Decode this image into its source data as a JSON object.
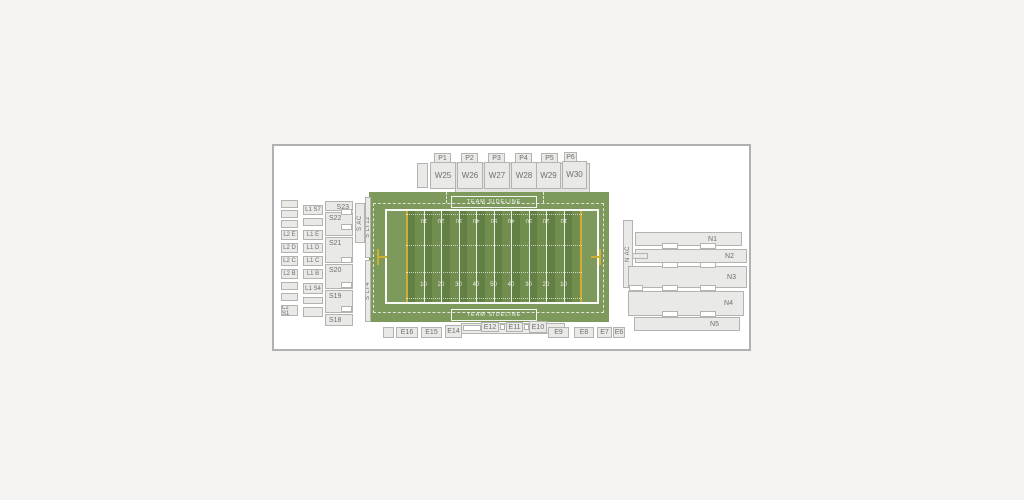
{
  "colors": {
    "page_bg": "#f5f4f2",
    "panel_bg": "#ffffff",
    "panel_border": "#b1b1b4",
    "section_fill": "#e9e9e7",
    "section_border": "#b3b3b0",
    "section_text": "#6f6f6f",
    "field_green": "#7d9a5c",
    "band_dark": "#627f44",
    "band_light": "#718e4f",
    "goal_yellow": "#cfae35"
  },
  "field": {
    "sideline_label": "TEAM SIDELINE",
    "yard_numbers": [
      "10",
      "20",
      "30",
      "40",
      "50",
      "40",
      "30",
      "20",
      "10"
    ]
  },
  "west": {
    "pods": [
      {
        "tab": "P1",
        "label": "W25"
      },
      {
        "tab": "P2",
        "label": "W26"
      },
      {
        "tab": "P3",
        "label": "W27"
      },
      {
        "tab": "P4",
        "label": "W28"
      },
      {
        "tab": "P5",
        "label": "W29"
      },
      {
        "tab": "P6",
        "label": "W30"
      }
    ]
  },
  "east": {
    "sections": [
      "E16",
      "E15",
      "E14",
      "E12",
      "E11",
      "E10",
      "E9",
      "E8",
      "E7",
      "E6"
    ]
  },
  "south": {
    "l2": [
      "L2 E",
      "L2 D",
      "L2 C",
      "L2 B",
      "L2 S1"
    ],
    "l1": [
      "L1 S7",
      "L1 E",
      "L1 D",
      "L1 C",
      "L1 B",
      "L1 S4"
    ],
    "s": [
      "S23",
      "S22",
      "S21",
      "S20",
      "S19",
      "S18"
    ],
    "s_ac": "S AC",
    "s_lt12": "S LT12",
    "s_lt4": "S LT4"
  },
  "north": {
    "n_ac": "N AC",
    "rows": [
      "N1",
      "N2",
      "N3",
      "N4",
      "N5"
    ]
  }
}
